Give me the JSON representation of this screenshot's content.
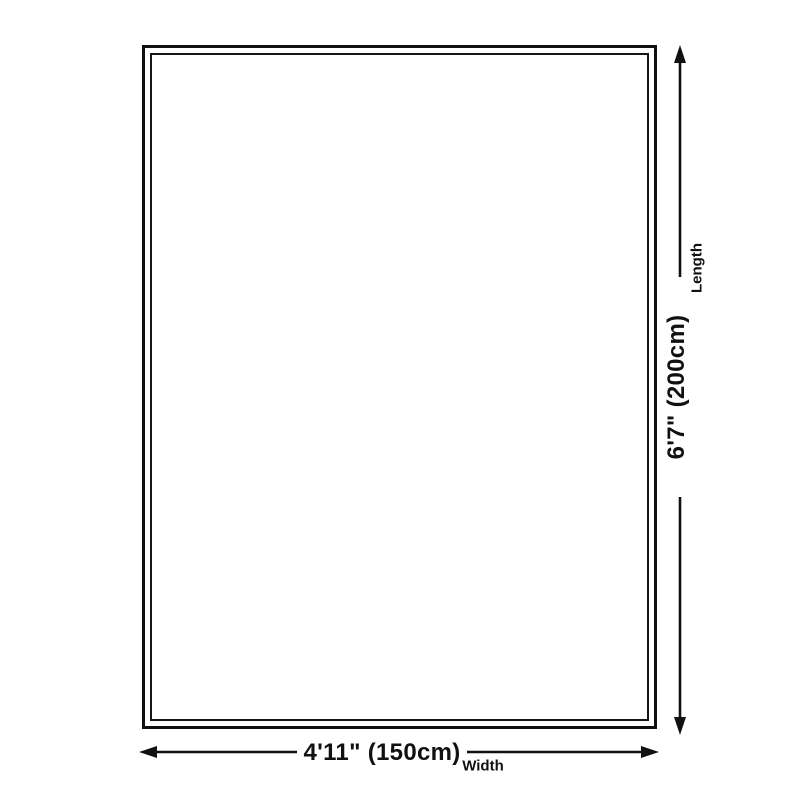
{
  "diagram": {
    "type": "size-diagram",
    "background": "#ffffff",
    "rug": {
      "outer_border_color": "#0f0f0f",
      "inner_border_color": "#161616",
      "fill": "#ffffff"
    },
    "line_color": "#111111",
    "text_color": "#111111",
    "length": {
      "value_label": "6'7\" (200cm)",
      "axis_label": "Length"
    },
    "width": {
      "value_label": "4'11\" (150cm)",
      "axis_label": "Width"
    }
  }
}
